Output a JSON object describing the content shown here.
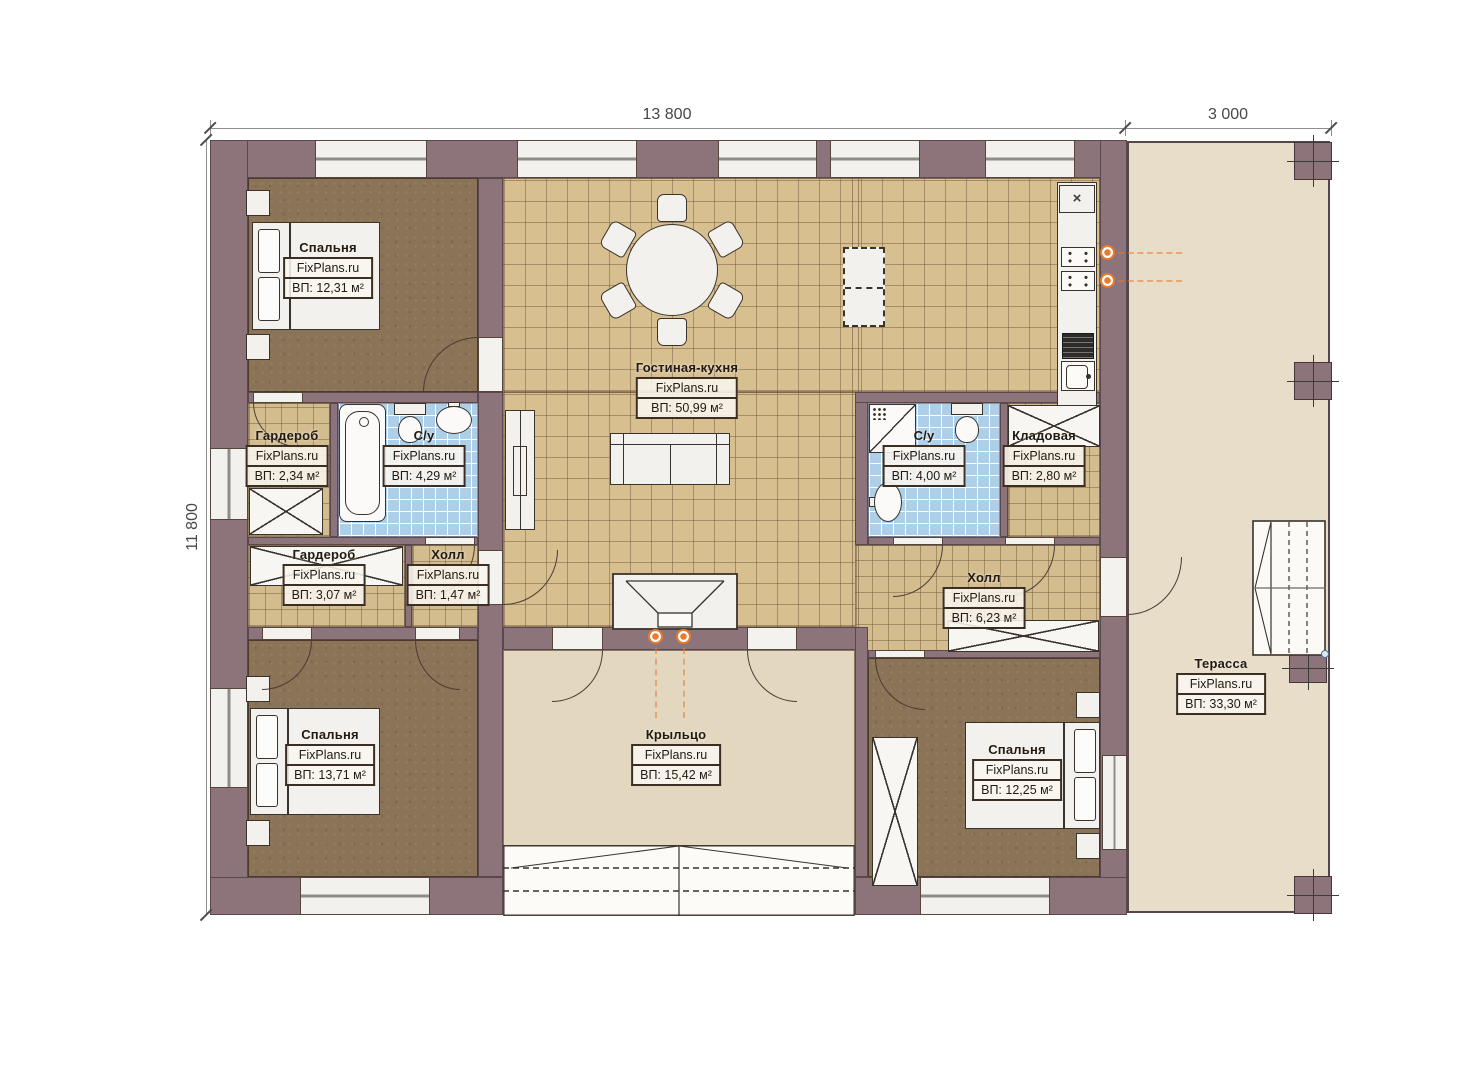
{
  "watermark": "FixPlans.ru",
  "dimensions": {
    "width_main": "13 800",
    "width_terrace": "3 000",
    "height": "11 800"
  },
  "rooms": {
    "bedroom_top_left": {
      "name": "Спальня",
      "area": "ВП: 12,31 м²"
    },
    "living_kitchen": {
      "name": "Гостиная-кухня",
      "area": "ВП: 50,99 м²"
    },
    "wardrobe_small": {
      "name": "Гардероб",
      "area": "ВП: 2,34 м²"
    },
    "bathroom_left": {
      "name": "С/у",
      "area": "ВП: 4,29 м²"
    },
    "wardrobe_large": {
      "name": "Гардероб",
      "area": "ВП: 3,07 м²"
    },
    "hall_small": {
      "name": "Холл",
      "area": "ВП: 1,47 м²"
    },
    "bedroom_bottom_left": {
      "name": "Спальня",
      "area": "ВП: 13,71 м²"
    },
    "bathroom_right": {
      "name": "С/у",
      "area": "ВП: 4,00 м²"
    },
    "storage": {
      "name": "Кладовая",
      "area": "ВП: 2,80 м²"
    },
    "hall_large": {
      "name": "Холл",
      "area": "ВП: 6,23 м²"
    },
    "bedroom_bottom_right": {
      "name": "Спальня",
      "area": "ВП: 12,25 м²"
    },
    "porch": {
      "name": "Крыльцо",
      "area": "ВП: 15,42 м²"
    },
    "terrace": {
      "name": "Терасса",
      "area": "ВП: 33,30 м²"
    }
  },
  "icons": {
    "kitchen_vent": "×"
  },
  "colors": {
    "wall": "#8d737a",
    "wood_floor": "#8a7356",
    "tile_floor": "#d7bf90",
    "bath_tile": "#aecfe8",
    "porch_floor": "#e3d7c0",
    "terrace_floor": "#e8ddc9",
    "lamp_orange": "#e87b2d"
  }
}
